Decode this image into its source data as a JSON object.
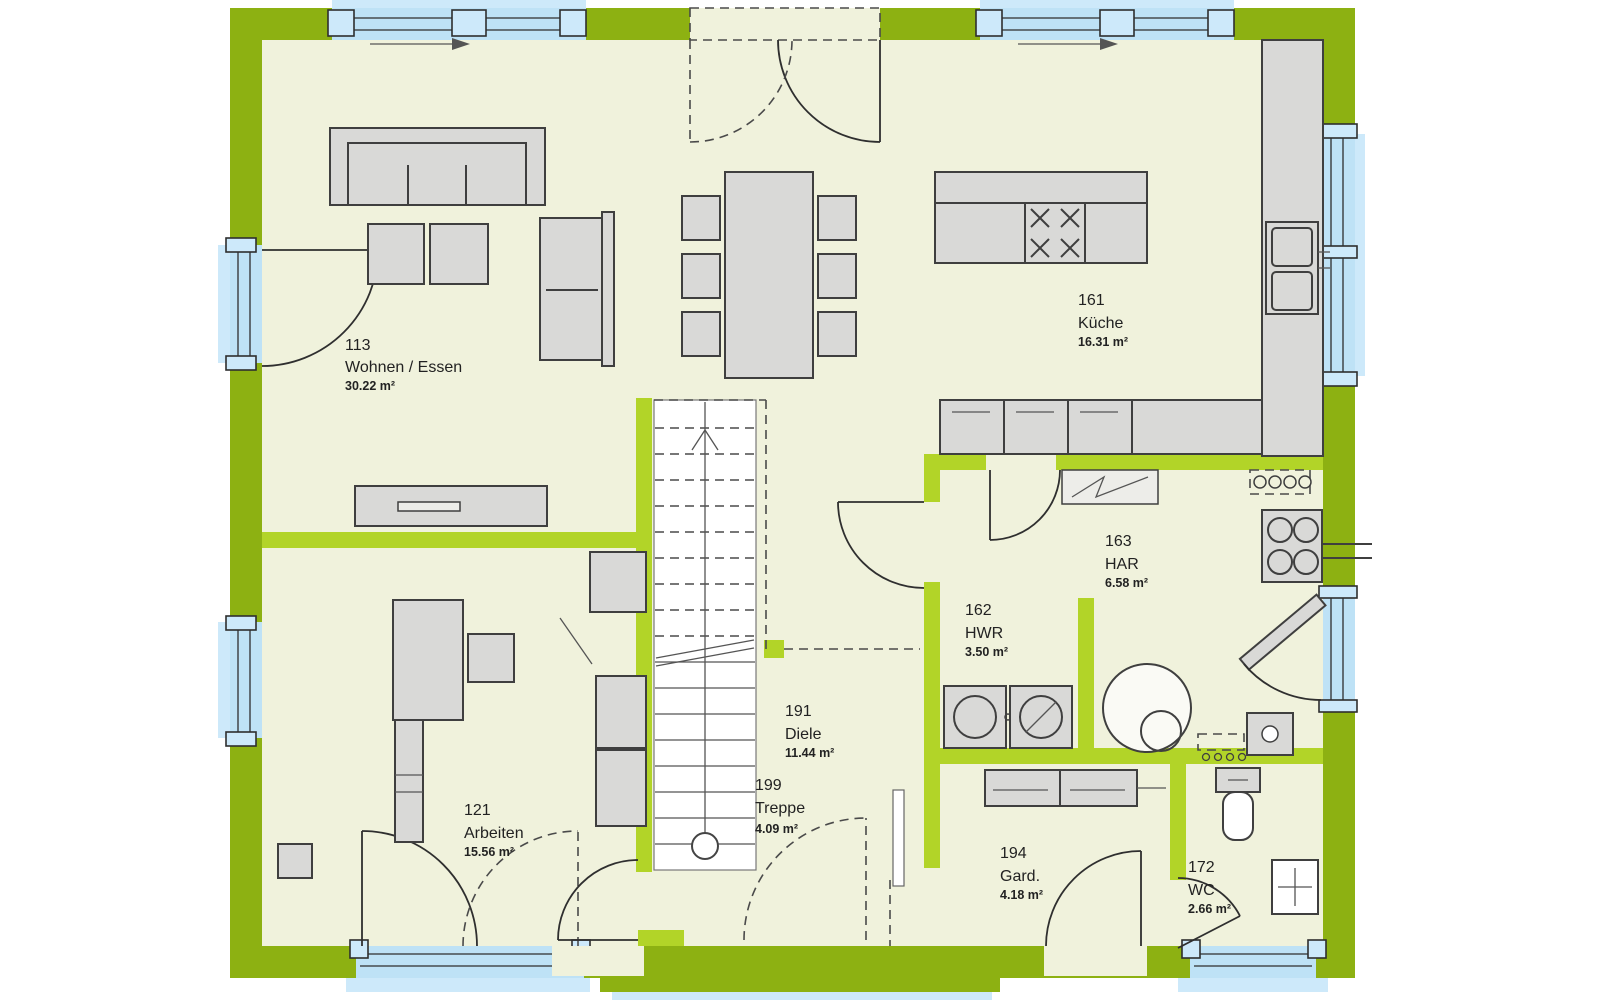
{
  "plan": {
    "rooms": [
      {
        "number": "113",
        "name": "Wohnen / Essen",
        "area": "30.22 m²"
      },
      {
        "number": "161",
        "name": "Küche",
        "area": "16.31 m²"
      },
      {
        "number": "163",
        "name": "HAR",
        "area": "6.58 m²"
      },
      {
        "number": "162",
        "name": "HWR",
        "area": "3.50 m²"
      },
      {
        "number": "191",
        "name": "Diele",
        "area": "11.44 m²"
      },
      {
        "number": "199",
        "name": "Treppe",
        "area": "4.09 m²"
      },
      {
        "number": "121",
        "name": "Arbeiten",
        "area": "15.56 m²"
      },
      {
        "number": "194",
        "name": "Gard.",
        "area": "4.18 m²"
      },
      {
        "number": "172",
        "name": "WC",
        "area": "2.66 m²"
      }
    ],
    "colors": {
      "wall_exterior": "#8DB112",
      "wall_interior": "#B2D428",
      "floor": "#F0F2DC",
      "window_glass": "#BEE2F6",
      "furniture": "#D9D9D7"
    }
  }
}
